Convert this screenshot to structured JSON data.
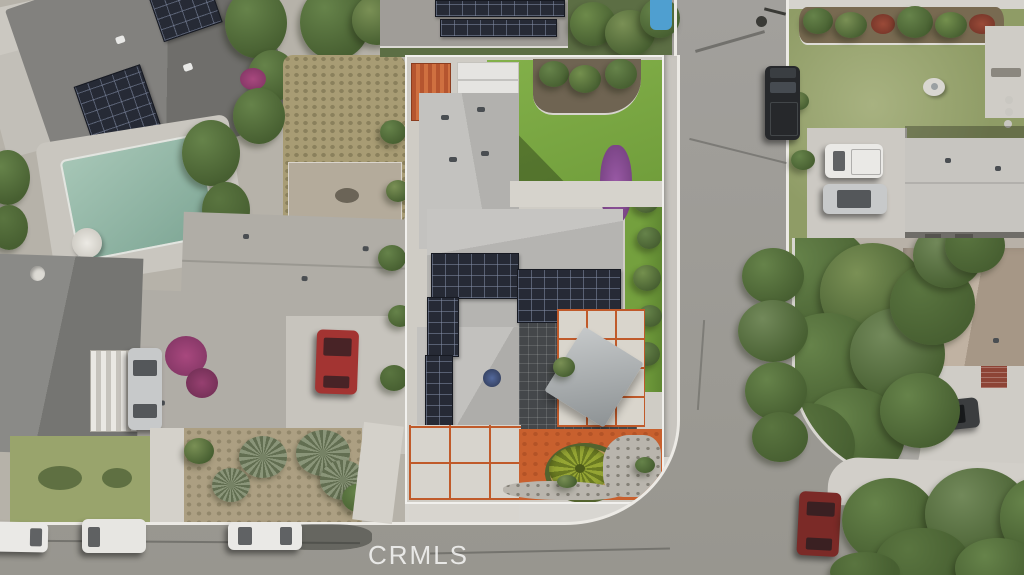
{
  "watermark": {
    "text": "CRMLS"
  },
  "palette": {
    "asphalt": "#a2a09c",
    "ground": "#b6b2a9",
    "concrete": "#cfccc5",
    "sidewalk": "#d8d6d1",
    "curb": "#eceae5",
    "walkway": "#d4d1ca",
    "patio_concrete": "#d9d5cc",
    "roof_subject": "#bdbcb9",
    "roof_dark": "#787774",
    "roof_warm": "#b0ada6",
    "roof_pale": "#c7c5c0",
    "roof_tan": "#b3a494",
    "roof_top": "#a09d98",
    "solar": "#262a35",
    "lawn_bright": "#7aa945",
    "lawn_olive": "#8f9c66",
    "lawn_patchy": "#99a46c",
    "pool_water": "#8fb7a6",
    "pool_deck": "#c9c6bf",
    "pool_glimpse": "#4f9fd0",
    "tree_light": "#66834a",
    "tree_dark": "#475f31",
    "mulch": "#6f6452",
    "dirt": "#b4ab9b",
    "brush": "#a89c74",
    "scrub": "#ac9f82",
    "gravel": "#b9b5ad",
    "orange_dg": "#c8602e",
    "orange_line": "#c05a2a",
    "pergola": "#44474a",
    "shed_orange": "#b5552f",
    "shed_white": "#e5e4e1",
    "purple_bush": "#8a4d97",
    "magenta": "#a8487e",
    "red_car": "#a33432",
    "dark_red_car": "#7b2a27",
    "black_truck": "#26282b",
    "white_vehicle": "#eae9e6",
    "silver_vehicle": "#c7c9ca",
    "dark_car": "#3b3d3f",
    "brick": "#8d4436",
    "watermark_color": "rgba(255,255,255,0.78)"
  }
}
